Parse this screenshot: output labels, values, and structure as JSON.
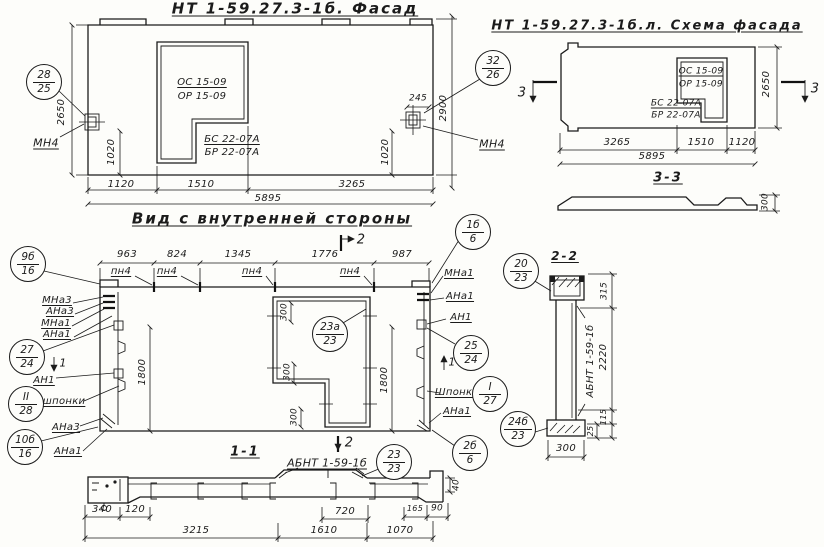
{
  "sheet": {
    "bg_color": "#fdfdfa",
    "ink_color": "#1b1b1b",
    "drawing_type": "hand-drawn panel fabrication drawing"
  },
  "titles": {
    "facade": "НТ 1-59.27.3-1б. Фасад",
    "scheme": "НТ 1-59.27.3-1б.л. Схема фасада",
    "inner_view": "Вид с внутренней стороны",
    "section_11": "1-1",
    "section_22": "2-2",
    "section_33": "3-3"
  },
  "window_marks": {
    "os": "ОС 15-09",
    "or": "ОР 15-09",
    "bs": "БС 22-07А",
    "br": "БР 22-07А"
  },
  "panel_marks": {
    "mn4": "МН4",
    "pn4": "пн4",
    "mna3": "МНа3",
    "ana3": "АНа3",
    "mna1": "МНа1",
    "ana1": "АНа1",
    "an1": "АН1",
    "shponki_uc": "Шпонки",
    "shponki_lc": "шпонки",
    "abnt": "АБНТ 1-59-1б"
  },
  "dims": {
    "d2650": "2650",
    "d2900": "2900",
    "d1020": "1020",
    "d1120": "1120",
    "d1510": "1510",
    "d3265": "3265",
    "d5895": "5895",
    "d245": "245",
    "d963": "963",
    "d824": "824",
    "d1345": "1345",
    "d1776": "1776",
    "d987": "987",
    "d1800": "1800",
    "d300": "300",
    "d340": "340",
    "d120": "120",
    "d3215": "3215",
    "d720": "720",
    "d1610": "1610",
    "d1070": "1070",
    "d165": "165",
    "d90": "90",
    "d40": "40",
    "d315": "315",
    "d2220": "2220",
    "d115": "115",
    "d25": "25"
  },
  "section_cuts": {
    "s1": "1",
    "s2": "2",
    "s3": "3"
  },
  "markers": [
    {
      "top": "28",
      "bottom": "25"
    },
    {
      "top": "32",
      "bottom": "26"
    },
    {
      "top": "9б",
      "bottom": "16"
    },
    {
      "top": "27",
      "bottom": "24"
    },
    {
      "top": "II",
      "bottom": "28"
    },
    {
      "top": "10б",
      "bottom": "16"
    },
    {
      "top": "1б",
      "bottom": "6"
    },
    {
      "top": "25",
      "bottom": "24"
    },
    {
      "top": "I",
      "bottom": "27"
    },
    {
      "top": "2б",
      "bottom": "6"
    },
    {
      "top": "23а",
      "bottom": "23"
    },
    {
      "top": "23",
      "bottom": "23"
    },
    {
      "top": "20",
      "bottom": "23"
    },
    {
      "top": "24б",
      "bottom": "23"
    }
  ]
}
